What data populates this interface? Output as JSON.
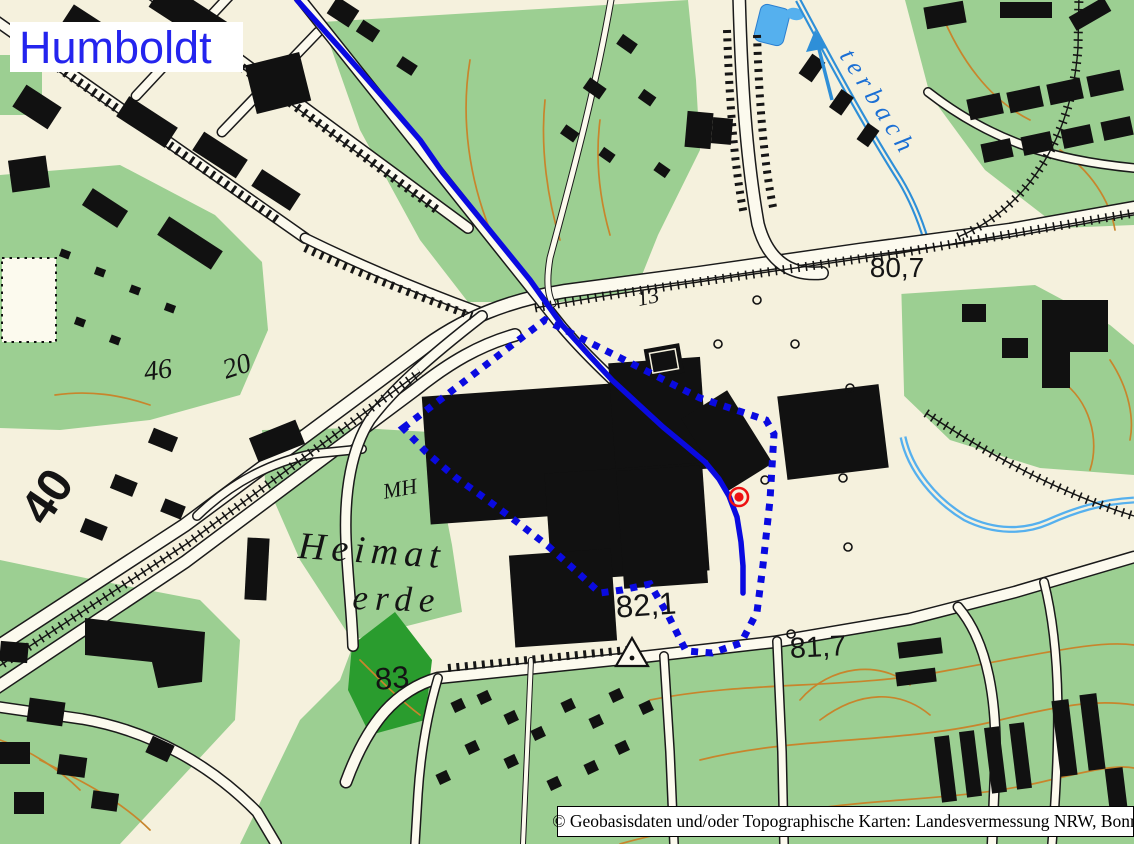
{
  "map": {
    "region_label": "Humboldt",
    "attribution": "© Geobasisdaten und/oder Topographische Karten: Landesvermessung NRW, Bonn",
    "spot_heights": {
      "h807": "80,7",
      "h821": "82,1",
      "h817": "81,7",
      "h83": "83"
    },
    "small_labels": {
      "n13": "13",
      "n46": "46",
      "n20": "20",
      "motorway": "40",
      "mh": "MH",
      "heimat": "Heimat",
      "erde": "erde",
      "stream": "terbach"
    },
    "colors": {
      "overlay_blue": "#0a0ae0",
      "marker_red": "#ee1111",
      "label_blue": "#2424ee",
      "stream_label_blue": "#1b6fd4",
      "water_blue": "#55b0ee",
      "green": "#9ccf92",
      "forest_green": "#2a9c2e",
      "contour_orange": "#c8852c",
      "background_cream": "#f5f1dd"
    }
  }
}
